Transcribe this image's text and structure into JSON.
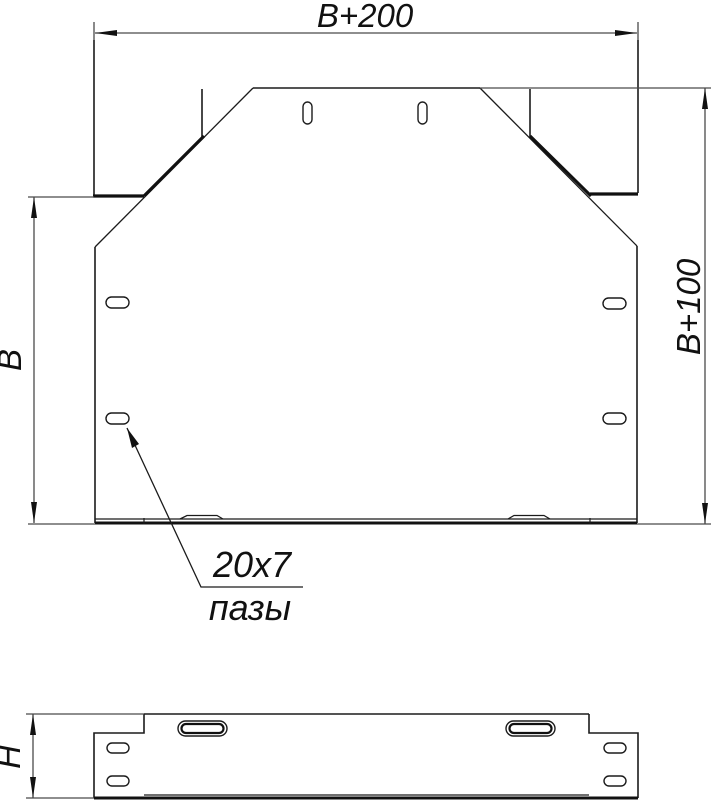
{
  "drawing": {
    "title": "tee-cover-dimension-drawing",
    "labels": {
      "overall_width": "B+200",
      "overall_depth": "B+100",
      "inner_width": "B",
      "height": "H",
      "slot_size": "20x7",
      "slot_name": "пазы"
    },
    "colors": {
      "background": "#ffffff",
      "outline": "#1b1b1b",
      "thick_edge": "#111111",
      "dimension": "#4a4a4a"
    }
  }
}
